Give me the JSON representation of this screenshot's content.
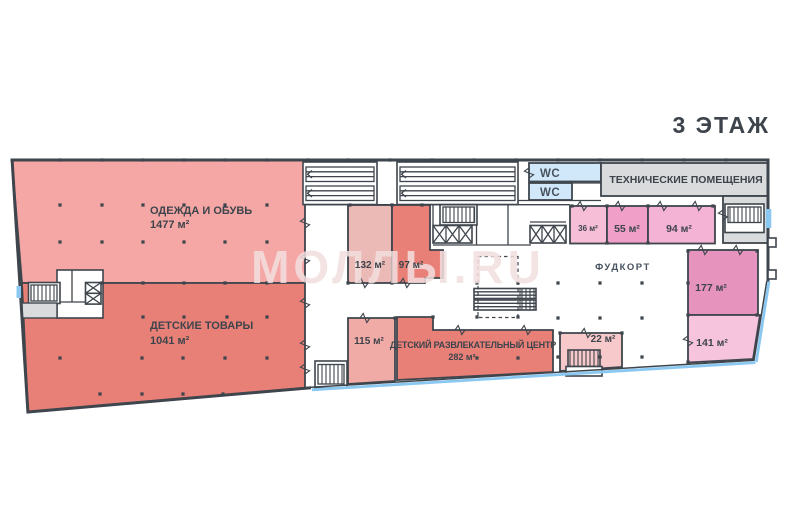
{
  "title": "3 ЭТАЖ",
  "watermark": "МОЛЛЫ.RU",
  "palette": {
    "wall": "#3e454c",
    "text": "#3d444b",
    "facade_glass": "#8ac8f2"
  },
  "rooms": {
    "clothes": {
      "name": "ОДЕЖДА И ОБУВЬ",
      "area": "1477 м²",
      "color": "#f5a7a5"
    },
    "kids_goods": {
      "name": "ДЕТСКИЕ ТОВАРЫ",
      "area": "1041 м²",
      "color": "#e98078"
    },
    "r132": {
      "area": "132 м²",
      "color": "#ecbab6"
    },
    "r97": {
      "area": "97 м²",
      "color": "#e98078"
    },
    "r115": {
      "area": "115 м²",
      "color": "#f1aba6"
    },
    "kids_center": {
      "name": "ДЕТСКИЙ РАЗВЛЕКАТЕЛЬНЫЙ ЦЕНТР",
      "area": "282 м²",
      "color": "#e98078"
    },
    "r22": {
      "area": "22 м²",
      "color": "#f7c9ca"
    },
    "r36": {
      "area": "36 м²",
      "color": "#f7bed8"
    },
    "r55": {
      "area": "55 м²",
      "color": "#f0a0c8"
    },
    "r94": {
      "area": "94 м²",
      "color": "#f4b2d4"
    },
    "r177": {
      "area": "177 м²",
      "color": "#e693bd"
    },
    "r141": {
      "area": "141 м²",
      "color": "#f6c4dc"
    },
    "foodcourt": {
      "name": "ФУДКОРТ"
    },
    "wc": {
      "label": "WC",
      "color": "#d0e8fa"
    },
    "technical": {
      "name": "ТЕХНИЧЕСКИЕ ПОМЕЩЕНИЯ",
      "color": "#dadbdc"
    }
  }
}
